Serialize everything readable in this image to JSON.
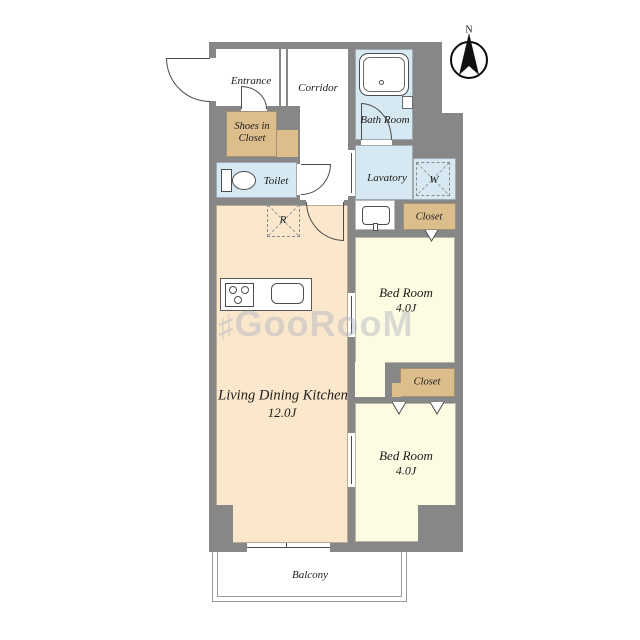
{
  "compass": {
    "label": "N"
  },
  "watermark": {
    "prefix": "♯",
    "text": "GooRooM"
  },
  "rooms": {
    "entrance": {
      "label": "Entrance"
    },
    "corridor": {
      "label": "Corridor"
    },
    "bath": {
      "label": "Bath Room"
    },
    "shoes": {
      "line1": "Shoes in",
      "line2": "Closet"
    },
    "toilet": {
      "label": "Toilet"
    },
    "lavatory": {
      "label": "Lavatory"
    },
    "washer": {
      "label": "W"
    },
    "fridge": {
      "label": "R"
    },
    "closet_top": {
      "label": "Closet"
    },
    "closet_mid": {
      "label": "Closet"
    },
    "bedroom1": {
      "label": "Bed Room",
      "size": "4.0J"
    },
    "bedroom2": {
      "label": "Bed Room",
      "size": "4.0J"
    },
    "ldk": {
      "label": "Living Dining Kitchen",
      "size": "12.0J"
    },
    "balcony": {
      "label": "Balcony"
    }
  },
  "colors": {
    "wall": "#878787",
    "water_rooms": "#D6E9F2",
    "closet": "#DCBE8C",
    "ldk": "#FAE7CC",
    "bedroom": "#FDFCE2",
    "fixture_line": "#4d4d4d",
    "balcony_line": "#9a9a9a",
    "text": "#1b1b1b",
    "watermark": "#aab0c0"
  }
}
